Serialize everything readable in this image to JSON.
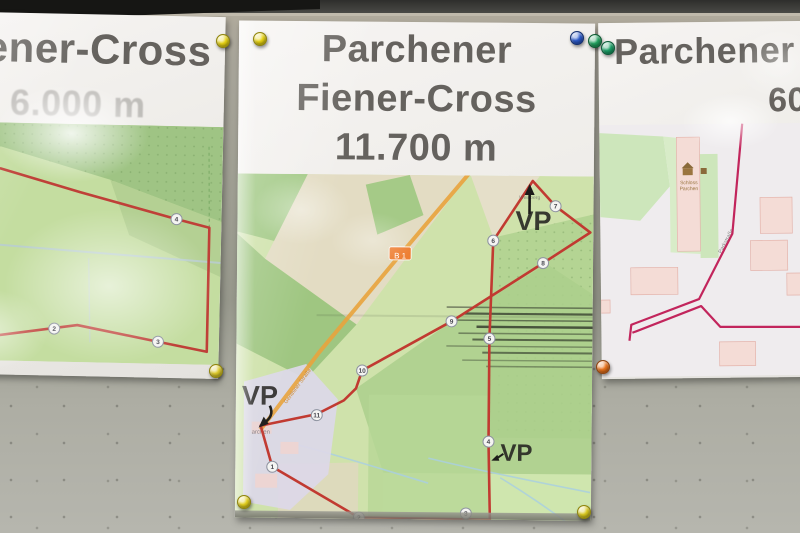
{
  "posters": {
    "left": {
      "title_line1": "Fiener-Cross",
      "title_line2": "6.000 m",
      "route_color": "#bf4038",
      "markers": [
        {
          "label": "2",
          "x": 127,
          "y": 205
        },
        {
          "label": "3",
          "x": 231,
          "y": 216
        },
        {
          "label": "4",
          "x": 247,
          "y": 93
        }
      ]
    },
    "center": {
      "title_line1": "Parchener",
      "title_line2": "Fiener-Cross",
      "title_line3": "11.700 m",
      "route_color": "#c13a31",
      "road_shield": "B 1",
      "street_label": "Genthiner Straße",
      "village_label": "archen",
      "north_place_label": "Weinberg",
      "vp_north": "VP",
      "vp_west": "VP",
      "vp_south": "VP",
      "markers": [
        {
          "label": "1",
          "x": 37,
          "y": 293
        },
        {
          "label": "2",
          "x": 124,
          "y": 343
        },
        {
          "label": "3",
          "x": 231,
          "y": 338
        },
        {
          "label": "4",
          "x": 253,
          "y": 266
        },
        {
          "label": "5",
          "x": 253,
          "y": 163
        },
        {
          "label": "6",
          "x": 256,
          "y": 65
        },
        {
          "label": "7",
          "x": 318,
          "y": 30
        },
        {
          "label": "8",
          "x": 306,
          "y": 87
        },
        {
          "label": "9",
          "x": 215,
          "y": 146
        },
        {
          "label": "10",
          "x": 126,
          "y": 196
        },
        {
          "label": "11",
          "x": 81,
          "y": 241
        }
      ]
    },
    "right": {
      "title_line1": "Parchener",
      "title_line2": "60",
      "route_color": "#c2255c",
      "poi_label_line1": "Schloss",
      "poi_label_line2": "Parchen",
      "street_label": "Parkstraße"
    }
  },
  "pins": [
    {
      "name": "yellow-pin-left-poster-top",
      "color": "#e6d213",
      "edge": "#8f840c",
      "x": 222,
      "y": 40
    },
    {
      "name": "yellow-pin-center-top-left",
      "color": "#e6d213",
      "edge": "#8f840c",
      "x": 259,
      "y": 38
    },
    {
      "name": "blue-pin-center-top-right",
      "color": "#2b59c9",
      "edge": "#15306f",
      "x": 576,
      "y": 37
    },
    {
      "name": "green-pin-center-top-right",
      "color": "#22a05e",
      "edge": "#0e5c33",
      "x": 594,
      "y": 40
    },
    {
      "name": "teal-pin-right-poster-top",
      "color": "#1b9e66",
      "edge": "#0d5a39",
      "x": 607,
      "y": 47
    },
    {
      "name": "yellow-pin-left-poster-bottom",
      "color": "#ddc92a",
      "edge": "#8f840c",
      "x": 215,
      "y": 370
    },
    {
      "name": "orange-pin-right-poster-bottom",
      "color": "#e8721c",
      "edge": "#8f4410",
      "x": 602,
      "y": 366
    },
    {
      "name": "yellow-pin-center-bottom-left",
      "color": "#e2cf1d",
      "edge": "#8f840c",
      "x": 243,
      "y": 501
    },
    {
      "name": "yellow-pin-center-bottom-right",
      "color": "#d8c81f",
      "edge": "#8f840c",
      "x": 583,
      "y": 511
    }
  ]
}
